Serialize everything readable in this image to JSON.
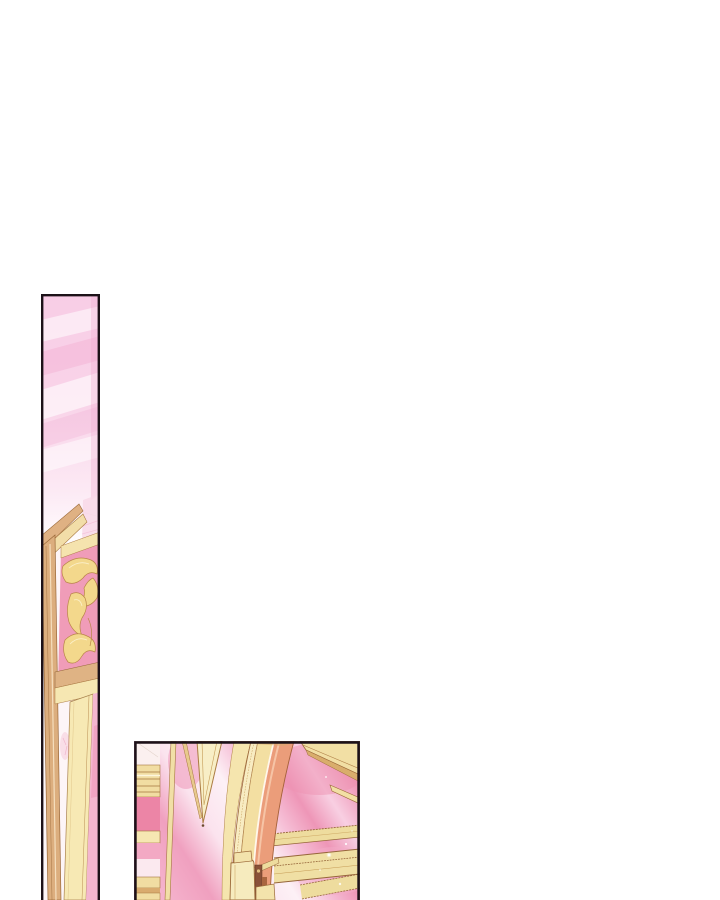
{
  "page": {
    "kind": "webtoon comic page (scrolled view, two cropped panels)",
    "background": "#ffffff"
  },
  "theme": {
    "line_color": "#1c1118",
    "pink_bg": "#f3a8c4",
    "pink_deep": "#ee93b4",
    "pink_panel": "#f09cb8",
    "pink_pale": "#fbdcea",
    "cream": "#f6e7b2",
    "gold": "#f3d88c",
    "gold_dark": "#9c6a3a",
    "tan": "#dcae7e",
    "salmon": "#eb9d7a",
    "warm_white": "#fdf1f6"
  },
  "panels": [
    {
      "id": "tall-strip-panel",
      "alt": "Tall narrow comic panel: sliver of a palace interior with pink striped wall fading to white, a gilded door frame seen edge-on, gold acanthus moulding on a pink panel, and cream pilaster strips running down",
      "x": 41,
      "y": 294,
      "width": 59,
      "height": 606
    },
    {
      "id": "arch-panel",
      "alt": "Cropped comic panel: grand gilded arch with a salmon inner band sweeping down, a hanging cream pennant ornament, a banded column at left, golden rails and a hinge bracket, white sparkles on a pink palace wall",
      "x": 134,
      "y": 741,
      "width": 226,
      "height": 159
    }
  ]
}
